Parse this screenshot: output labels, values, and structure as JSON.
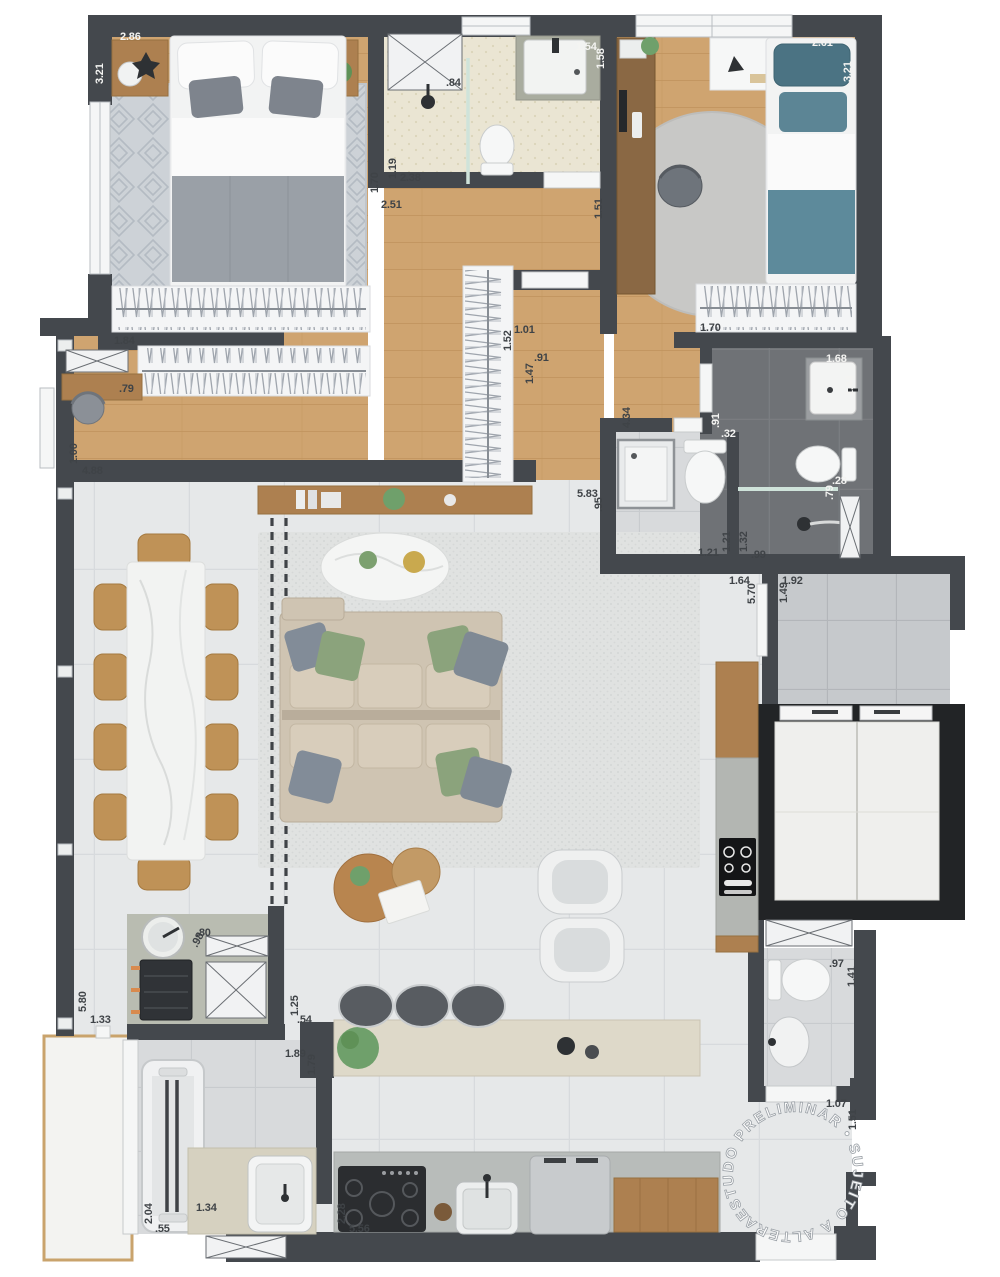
{
  "watermark": {
    "text": "ESTUDO PRELIMINAR • SUJEITO A ALTERAÇÃO •"
  },
  "palette": {
    "wall": "#44484d",
    "wood_floor": "#cfa470",
    "living_tile": "#e6e8e9",
    "hall_tile": "#c6c9cc",
    "bath_beige": "#eae5d3",
    "bath_dark": "#6f7276",
    "elevator_frame": "#222426",
    "counter_beige": "#ded9c9",
    "sofa": "#cfc4b2",
    "pillow_green": "#8ba37c",
    "pillow_gray": "#7f8994",
    "bed_teal": "#5d8a9b",
    "furniture_wood": "#ad8050",
    "label_dark": "#3f4347",
    "label_light": "#f4f4f2"
  },
  "dimensions": [
    {
      "t": "2.86",
      "x": 120,
      "y": 40,
      "l": 1
    },
    {
      "t": "3.21",
      "x": 103,
      "y": 84,
      "r": -90,
      "l": 1
    },
    {
      "t": "1.84",
      "x": 114,
      "y": 344
    },
    {
      "t": ".79",
      "x": 119,
      "y": 392
    },
    {
      "t": "1.00",
      "x": 77,
      "y": 464,
      "r": -90
    },
    {
      "t": "4.88",
      "x": 82,
      "y": 474
    },
    {
      "t": "1.70",
      "x": 378,
      "y": 193,
      "r": -90
    },
    {
      "t": "2.51",
      "x": 381,
      "y": 208
    },
    {
      "t": "1.19",
      "x": 396,
      "y": 179,
      "r": -90
    },
    {
      "t": "2.38",
      "x": 400,
      "y": 181
    },
    {
      "t": ".84",
      "x": 446,
      "y": 86
    },
    {
      "t": "1.54",
      "x": 576,
      "y": 50,
      "l": 1
    },
    {
      "t": "1.58",
      "x": 604,
      "y": 69,
      "r": -90,
      "l": 1
    },
    {
      "t": "1.51",
      "x": 602,
      "y": 219,
      "r": -90
    },
    {
      "t": "2.61",
      "x": 812,
      "y": 46,
      "l": 1
    },
    {
      "t": "3.21",
      "x": 851,
      "y": 82,
      "r": -90,
      "l": 1
    },
    {
      "t": "1.70",
      "x": 700,
      "y": 331
    },
    {
      "t": "1.01",
      "x": 514,
      "y": 333
    },
    {
      "t": "1.52",
      "x": 511,
      "y": 351,
      "r": -90
    },
    {
      "t": ".91",
      "x": 534,
      "y": 361
    },
    {
      "t": "1.47",
      "x": 533,
      "y": 384,
      "r": -90
    },
    {
      "t": "4.34",
      "x": 630,
      "y": 428,
      "r": -90
    },
    {
      "t": "5.83",
      "x": 577,
      "y": 497
    },
    {
      "t": ".95",
      "x": 602,
      "y": 512,
      "r": -90
    },
    {
      "t": "1.68",
      "x": 826,
      "y": 362,
      "l": 1
    },
    {
      "t": "1.44",
      "x": 853,
      "y": 396,
      "r": -90,
      "l": 1
    },
    {
      "t": ".91",
      "x": 719,
      "y": 428,
      "r": -90,
      "l": 1
    },
    {
      "t": ".32",
      "x": 721,
      "y": 437,
      "l": 1
    },
    {
      "t": "1.21",
      "x": 698,
      "y": 556
    },
    {
      "t": "1.21",
      "x": 730,
      "y": 552,
      "r": -90
    },
    {
      "t": "1.32",
      "x": 747,
      "y": 552,
      "r": -90
    },
    {
      "t": ".99",
      "x": 751,
      "y": 558
    },
    {
      "t": ".28",
      "x": 832,
      "y": 484,
      "l": 1
    },
    {
      "t": ".79",
      "x": 833,
      "y": 500,
      "r": -90,
      "l": 1
    },
    {
      "t": "1.64",
      "x": 729,
      "y": 584
    },
    {
      "t": "5.70",
      "x": 755,
      "y": 604,
      "r": -90
    },
    {
      "t": "1.92",
      "x": 782,
      "y": 584
    },
    {
      "t": "1.49",
      "x": 787,
      "y": 603,
      "r": -90
    },
    {
      "t": "5.80",
      "x": 86,
      "y": 1012,
      "r": -90
    },
    {
      "t": "1.33",
      "x": 90,
      "y": 1023
    },
    {
      "t": ".80",
      "x": 196,
      "y": 936
    },
    {
      "t": ".98",
      "x": 197,
      "y": 948,
      "r": -62
    },
    {
      "t": "1.25",
      "x": 298,
      "y": 1016,
      "r": -90
    },
    {
      "t": ".54",
      "x": 297,
      "y": 1023
    },
    {
      "t": "1.89",
      "x": 285,
      "y": 1057
    },
    {
      "t": "1.79",
      "x": 315,
      "y": 1075,
      "r": -90
    },
    {
      "t": "2.04",
      "x": 152,
      "y": 1224,
      "r": -90
    },
    {
      "t": ".55",
      "x": 155,
      "y": 1232
    },
    {
      "t": "1.34",
      "x": 196,
      "y": 1211
    },
    {
      "t": "2.28",
      "x": 345,
      "y": 1224,
      "r": -90
    },
    {
      "t": "5.56",
      "x": 349,
      "y": 1232
    },
    {
      "t": ".97",
      "x": 829,
      "y": 967
    },
    {
      "t": "1.41",
      "x": 855,
      "y": 987,
      "r": -90
    },
    {
      "t": "1.07",
      "x": 826,
      "y": 1107
    },
    {
      "t": "1.51",
      "x": 856,
      "y": 1130,
      "r": -90
    }
  ]
}
